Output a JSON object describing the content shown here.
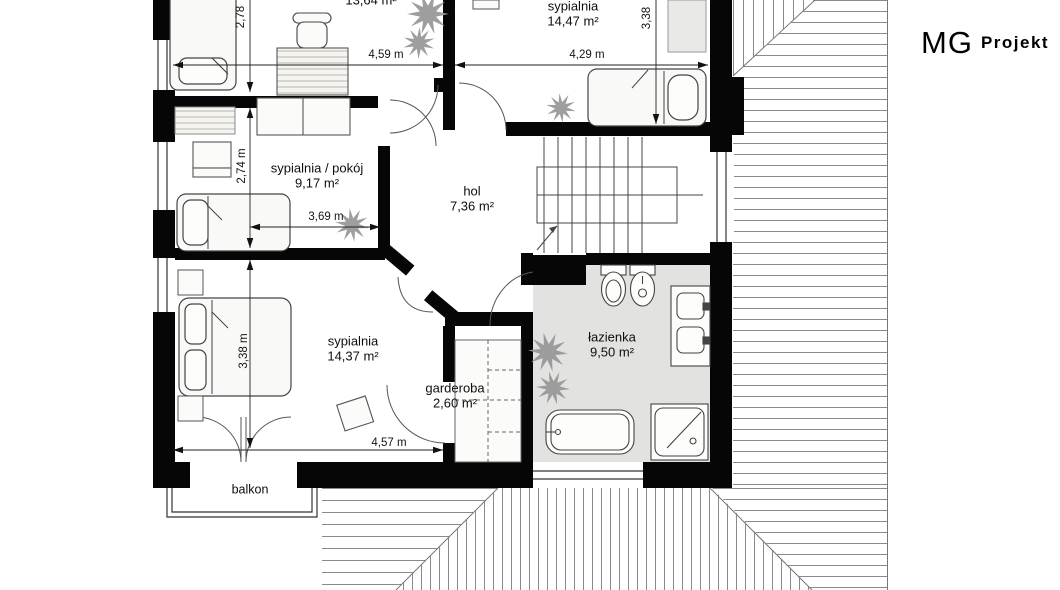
{
  "logo": {
    "mg": "MG",
    "projekt": "Projekt"
  },
  "rooms": [
    {
      "id": "room-top-left",
      "name": "",
      "area": "13,64 m²"
    },
    {
      "id": "bedroom-top-right",
      "name": "sypialnia",
      "area": "14,47 m²"
    },
    {
      "id": "bedroom-office",
      "name": "sypialnia / pokój",
      "area": "9,17 m²"
    },
    {
      "id": "hall",
      "name": "hol",
      "area": "7,36 m²"
    },
    {
      "id": "bathroom",
      "name": "łazienka",
      "area": "9,50 m²"
    },
    {
      "id": "bedroom-main",
      "name": "sypialnia",
      "area": "14,37 m²"
    },
    {
      "id": "wardrobe-room",
      "name": "garderoba",
      "area": "2,60 m²"
    },
    {
      "id": "balcony",
      "name": "balkon"
    }
  ],
  "dimensions": {
    "top_left_width": "4,59 m",
    "top_right_width": "4,29 m",
    "top_left_depth": "2,78",
    "top_right_depth": "3,38",
    "middle_depth": "2,74 m",
    "middle_width": "3,69 m",
    "bottom_depth": "3,38 m",
    "bottom_width": "4,57 m"
  },
  "plan": {
    "furniture": [
      "bed",
      "double-bed",
      "desk",
      "chair",
      "wardrobe",
      "rug",
      "nightstand",
      "pouf",
      "bathtub",
      "shower",
      "washbasin",
      "toilet",
      "bidet",
      "plant",
      "staircase",
      "balcony-railing"
    ],
    "colors": {
      "wall": "#060606",
      "bathroom_floor": "#e2e2e0",
      "roof_hatch": "#8a8a8a",
      "furniture_stroke": "#444444"
    }
  }
}
